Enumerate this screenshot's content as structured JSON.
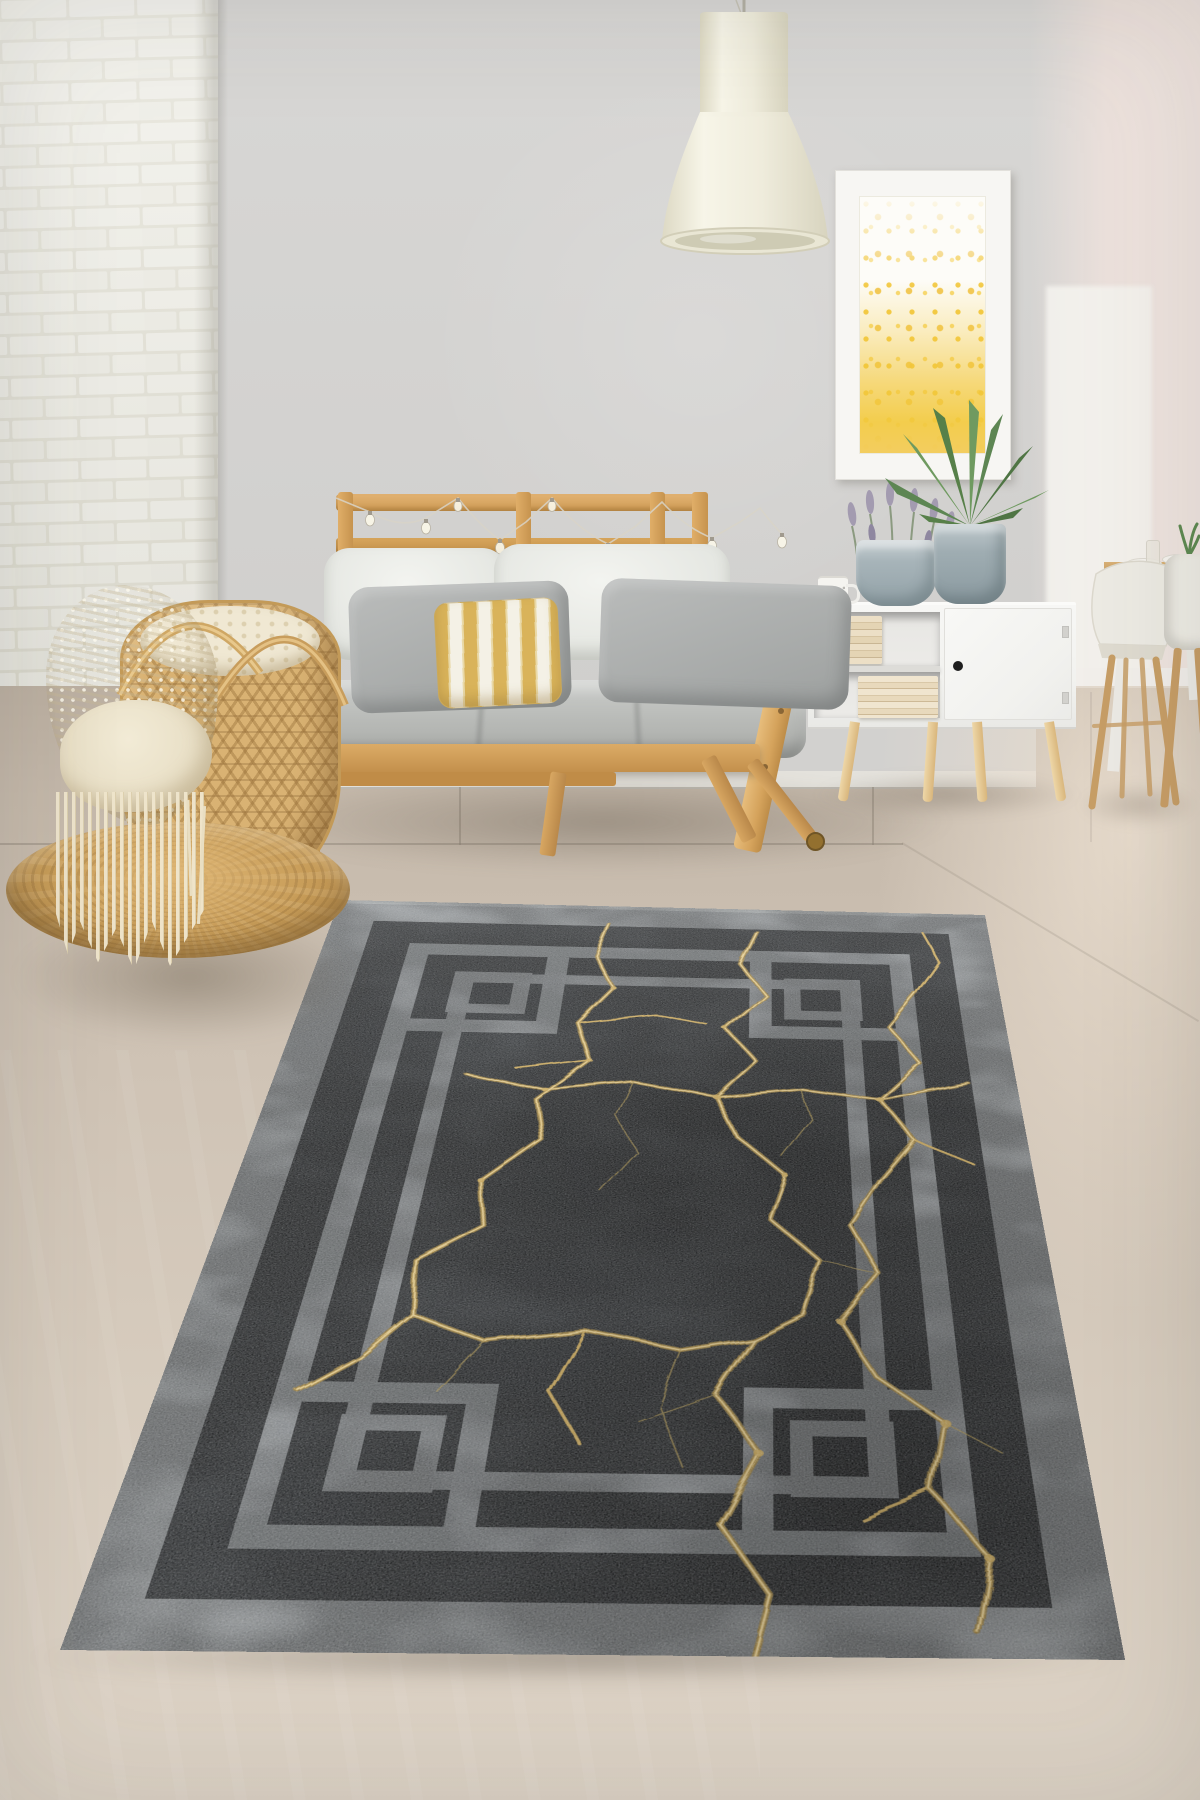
{
  "image": {
    "type": "product-lifestyle-photograph",
    "subject": "Black area rug with gold marble crack veins and silver geometric border, staged in a Scandinavian living room",
    "width_px": 1200,
    "height_px": 1800
  },
  "palette": {
    "rug_field": "#2c2e30",
    "rug_border_silver": "#a7abad",
    "rug_vein_gold": "#c9a44f",
    "rug_vein_highlight": "#eed9a0",
    "wall_gray": "#d3d2d0",
    "wall_pink": "#f1e6e1",
    "brick_white": "#eeede5",
    "floor_taupe": "#cfc3b5",
    "floor_dining_light": "#e9ddce",
    "wood_pine": "#d9a75f",
    "cushion_cream": "#eff0ec",
    "cushion_gray": "#a7aaa8",
    "pillow_gold_stripe": "#d9b35a",
    "lamp_cream": "#efecdb",
    "cabinet_white": "#f4f4f2",
    "basket_rattan": "#d9b273",
    "blanket_cream": "#efe7d2",
    "pouf_jute": "#c79c58",
    "plant_green": "#6f9a60",
    "art_yellow": "#f2c94e"
  },
  "objects": {
    "rug": {
      "label": "Dark gray rug with gold kintsugi marble veins, double silver line border and interlocking square corner motifs"
    },
    "pendant_lamp": {
      "label": "Cream bell-shaped pendant lamp"
    },
    "wall_art": {
      "label": "White framed abstract artwork with yellow speckles denser toward bottom"
    },
    "sofa": {
      "label": "Pine futon sofa with slatted backrest, cream back cushions, gray pillows and a gold striped pillow"
    },
    "string_lights": {
      "label": "Clear bulb string lights draped over sofa backrest"
    },
    "sideboard": {
      "label": "White sideboard with open book shelves, single door and tapered wooden legs"
    },
    "mug": {
      "label": "White speckled mug"
    },
    "lavender_pot": {
      "label": "Gray fabric pot with lavender"
    },
    "dracaena_pot": {
      "label": "Gray pot with spiky dracaena plant"
    },
    "dining_set": {
      "label": "Wooden dining table with white shell chairs"
    },
    "basket": {
      "label": "Rattan basket holding a chunky cream knit blanket with fringe"
    },
    "pouf": {
      "label": "Round braided jute pouf"
    },
    "brick_wall": {
      "label": "White painted brick accent wall"
    },
    "floor": {
      "label": "Beige tile floor"
    }
  }
}
